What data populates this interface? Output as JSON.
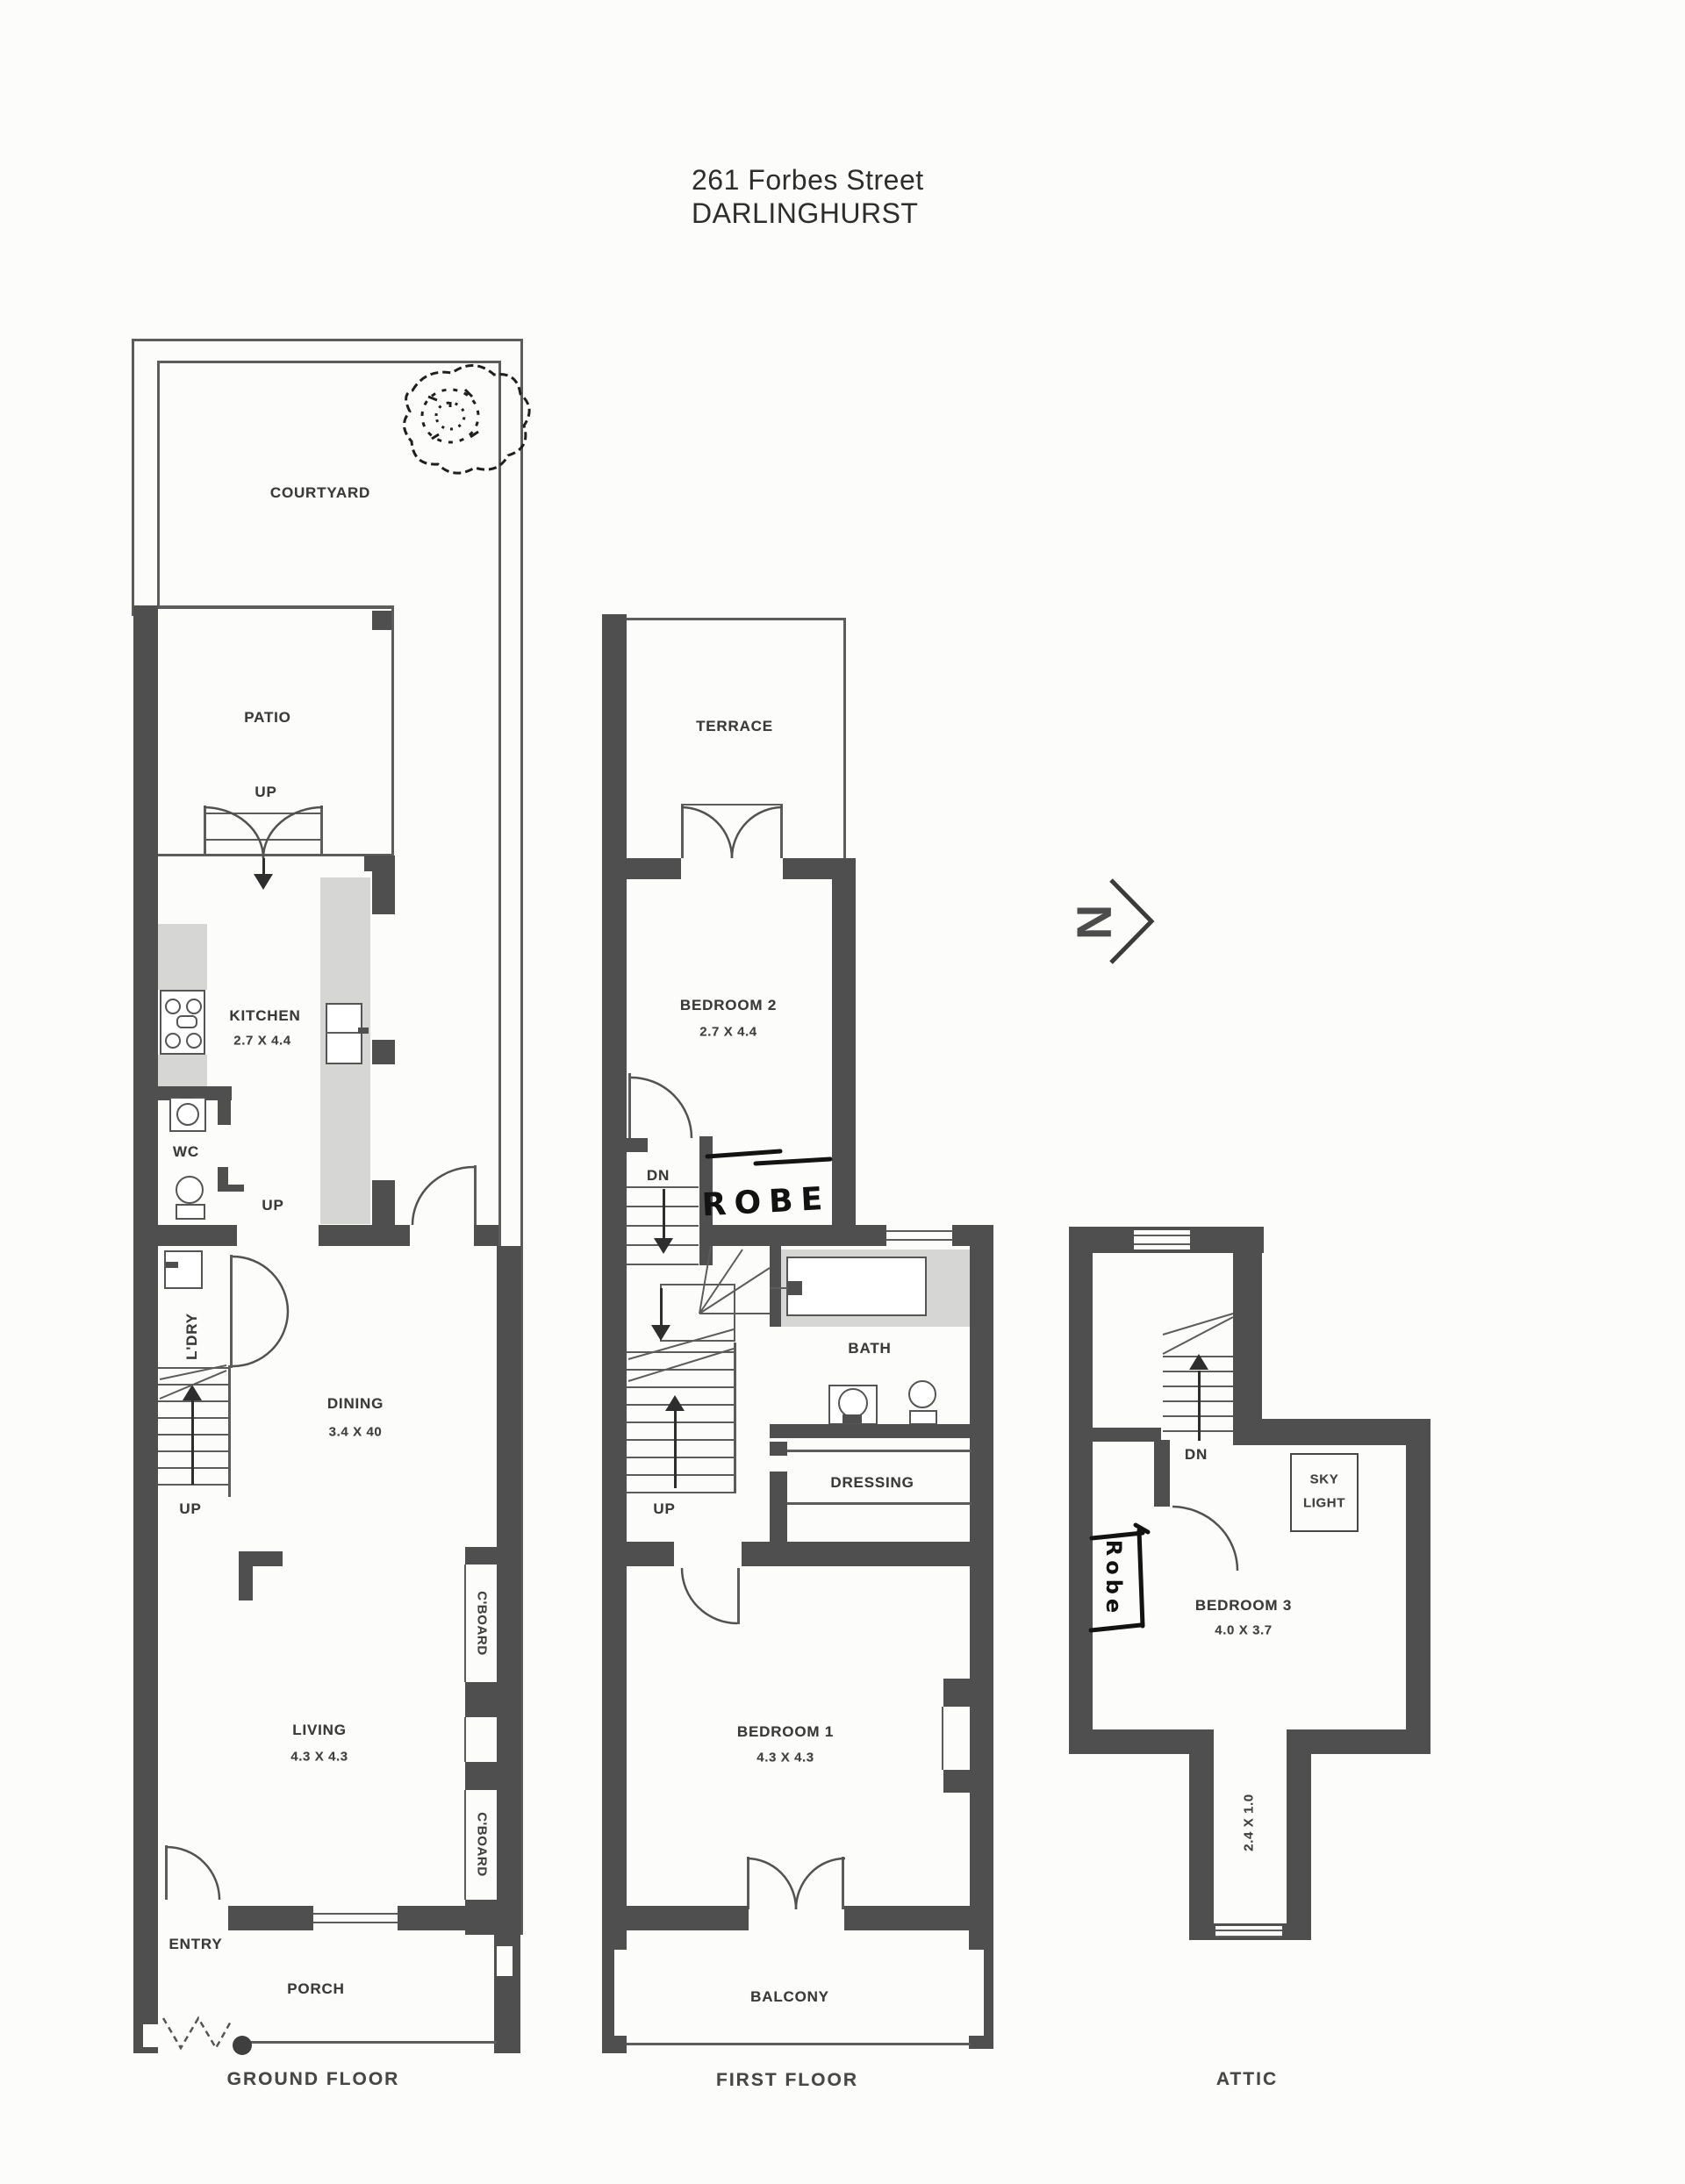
{
  "page": {
    "title_line1": "261 Forbes Street",
    "title_line2": "DARLINGHURST"
  },
  "north": {
    "label": "N"
  },
  "ground_floor": {
    "floor_label": "GROUND FLOOR",
    "labels": {
      "courtyard": "COURTYARD",
      "patio": "PATIO",
      "up": "UP",
      "kitchen_name": "KITCHEN",
      "kitchen_dims": "2.7 X 4.4",
      "wc": "WC",
      "laundry": "L'DRY",
      "dining_name": "DINING",
      "dining_dims": "3.4 X 40",
      "cupboard": "C'BOARD",
      "living_name": "LIVING",
      "living_dims": "4.3 X 4.3",
      "entry": "ENTRY",
      "porch": "PORCH"
    }
  },
  "first_floor": {
    "floor_label": "FIRST FLOOR",
    "labels": {
      "terrace": "TERRACE",
      "bedroom2_name": "BEDROOM 2",
      "bedroom2_dims": "2.7 X 4.4",
      "dn": "DN",
      "up": "UP",
      "bath": "BATH",
      "dressing": "DRESSING",
      "bedroom1_name": "BEDROOM 1",
      "bedroom1_dims": "4.3 X 4.3",
      "balcony": "BALCONY"
    },
    "annotations": {
      "robe": "ROBE"
    }
  },
  "attic": {
    "floor_label": "ATTIC",
    "labels": {
      "dn": "DN",
      "skylight_line1": "SKY",
      "skylight_line2": "LIGHT",
      "bedroom3_name": "BEDROOM 3",
      "bedroom3_dims": "4.0 X 3.7",
      "nook_dims": "2.4 X 1.0"
    },
    "annotations": {
      "robe": "Robe"
    }
  }
}
